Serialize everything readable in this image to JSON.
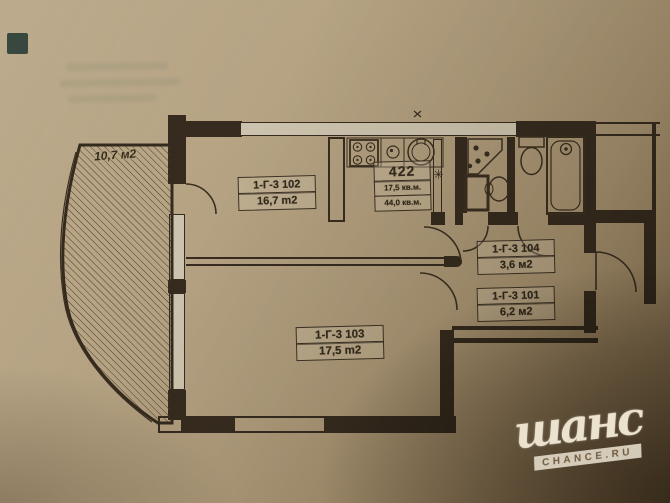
{
  "title": "Apartment floor plan — scanned photo",
  "balcony": {
    "area": "10,7 м2"
  },
  "rooms": {
    "living": {
      "id": "1-Г-3 102",
      "area": "16,7 m2"
    },
    "bedroom": {
      "id": "1-Г-3 103",
      "area": "17,5 m2"
    },
    "hall": {
      "id": "1-Г-3 104",
      "area": "3,6 м2"
    },
    "corridor": {
      "id": "1-Г-3 101",
      "area": "6,2 м2"
    }
  },
  "summary": {
    "number": "422",
    "living_area": "17,5 кв.м.",
    "total_area": "44,0 кв.м.",
    "marker": "✳"
  },
  "watermark": {
    "name": "шанс",
    "site": "CHANCE.RU"
  },
  "colors": {
    "paper": "#b29e7e",
    "ink": "#362b1e",
    "window_fill": "#ccc3ae",
    "shadow": "#5e4c32",
    "watermark_text": "#ece3cf"
  }
}
